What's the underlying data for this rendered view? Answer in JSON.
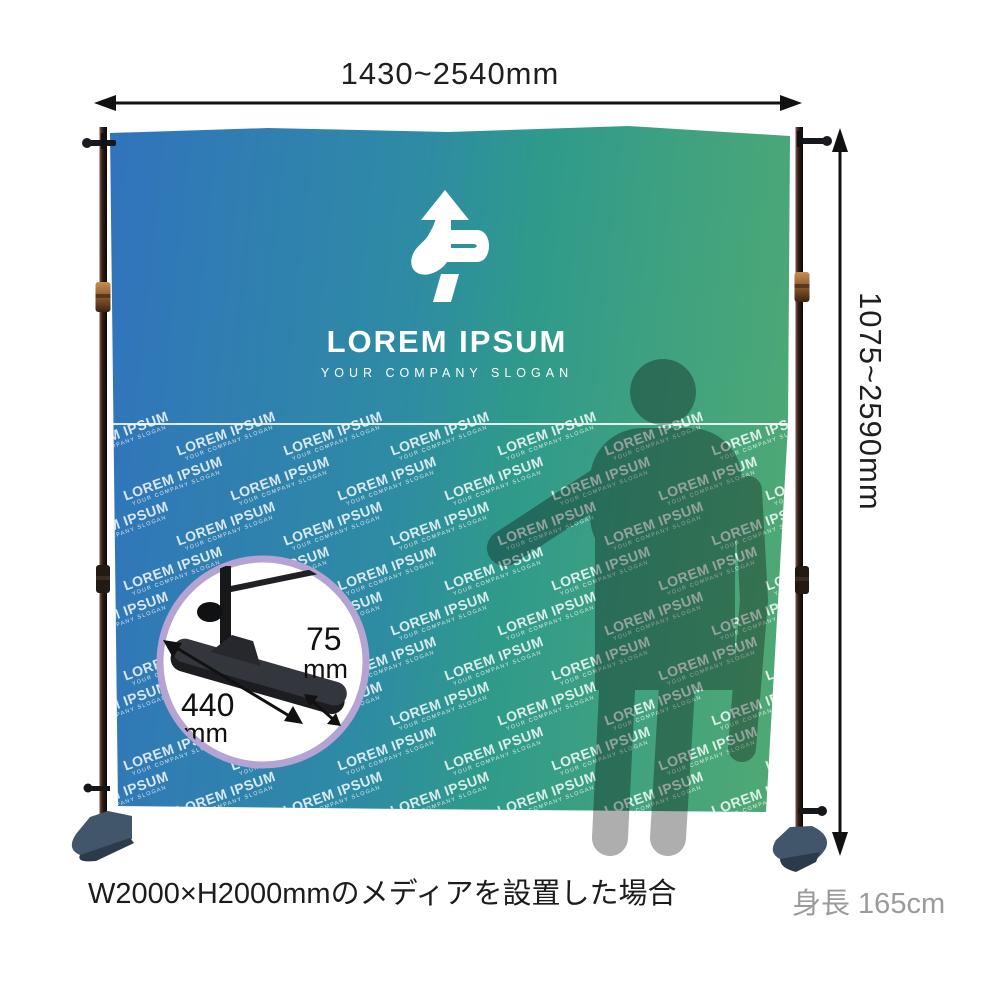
{
  "dimensions": {
    "width_label": "1430~2540mm",
    "height_label": "1075~2590mm",
    "base_length_value": "440",
    "base_length_unit": "mm",
    "base_width_value": "75",
    "base_width_unit": "mm"
  },
  "banner": {
    "logo_title": "LOREM IPSUM",
    "logo_slogan": "YOUR COMPANY SLOGAN",
    "watermark_title": "LOREM IPSUM",
    "watermark_slogan": "YOUR COMPANY SLOGAN"
  },
  "captions": {
    "media_note": "W2000×H2000mmのメディアを設置した場合",
    "height_note": "身長 165cm"
  },
  "colors": {
    "banner_blue": "#3173bd",
    "banner_teal": "#2f9a8b",
    "banner_green": "#52aa72",
    "dimension_text": "#1f1f1f",
    "height_note_text": "#9b9b9b",
    "detail_circle_border": "#b4a3d3",
    "silhouette_gray": "#aeaeae",
    "foot_plate": "#42566b",
    "pole_dark": "#2a1a12",
    "coupler_bronze": "#a06a3c"
  },
  "pattern": {
    "rows": 9,
    "cols": 8,
    "start_x": -40,
    "start_y": 300,
    "row_pitch": 45,
    "col_pitch": 107,
    "row_offset": 54,
    "rotation_deg": -20
  }
}
